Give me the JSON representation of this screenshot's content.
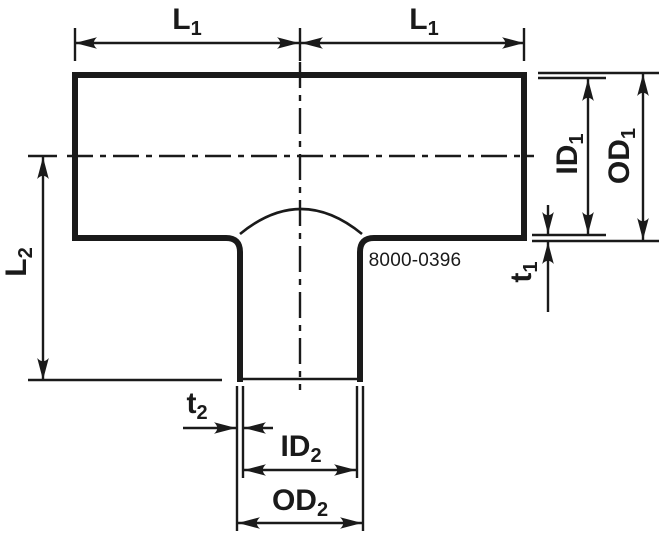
{
  "labels": {
    "l1_left": {
      "main": "L",
      "sub": "1"
    },
    "l1_right": {
      "main": "L",
      "sub": "1"
    },
    "l2": {
      "main": "L",
      "sub": "2"
    },
    "id1": {
      "main": "ID",
      "sub": "1"
    },
    "od1": {
      "main": "OD",
      "sub": "1"
    },
    "t1": {
      "main": "t",
      "sub": "1"
    },
    "t2": {
      "main": "t",
      "sub": "2"
    },
    "id2": {
      "main": "ID",
      "sub": "2"
    },
    "od2": {
      "main": "OD",
      "sub": "2"
    }
  },
  "part_number": "8000-0396",
  "colors": {
    "line": "#1a1a1a",
    "background": "#ffffff"
  }
}
